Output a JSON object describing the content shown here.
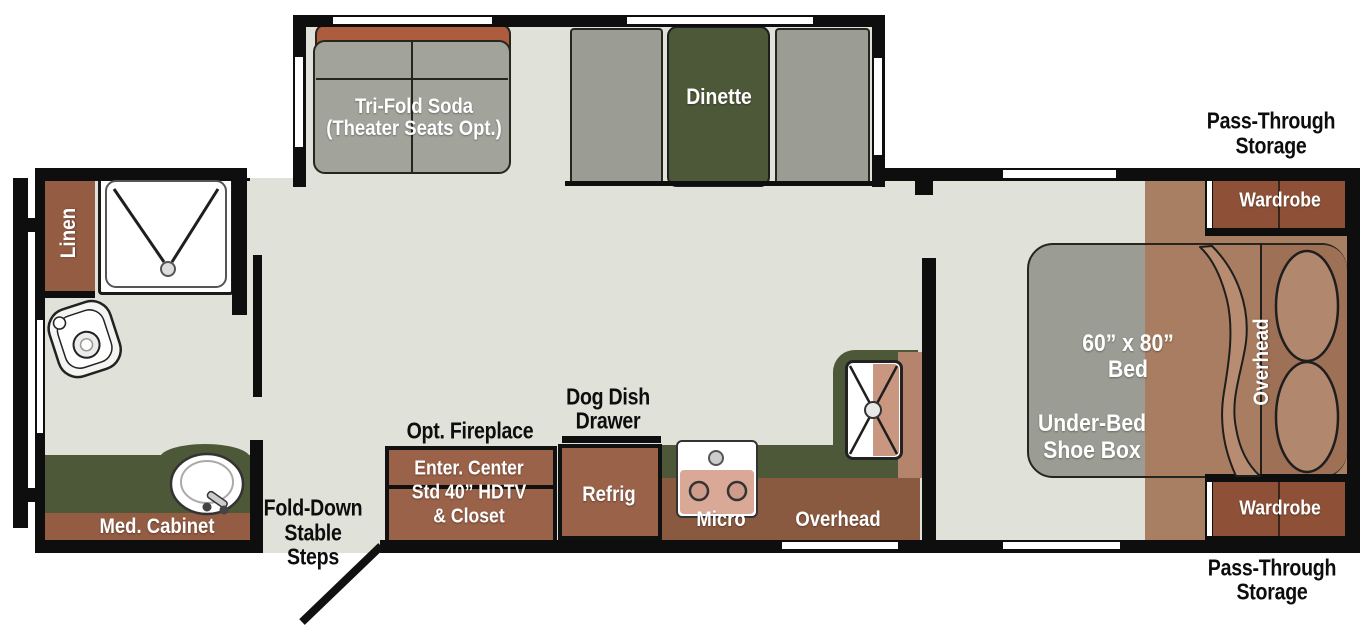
{
  "colors": {
    "floor": "#e0e1d8",
    "wall": "#0e0e0e",
    "cabinet_brown": "#9a6249",
    "dark_cabinet_brown": "#8e5138",
    "overhead_brown": "#8a5a40",
    "sofa_rust": "#ad5c3d",
    "cushion_gray": "#a2a49c",
    "counter_green": "#4c5837",
    "bedroom_floor": "#a97f63",
    "bed_gray": "#9b9d94",
    "bed_blanket": "#a87d61",
    "pillow": "#b1876d",
    "appliance_pink": "#d9a896"
  },
  "slideout": {
    "sofa_label_1": "Tri-Fold Soda",
    "sofa_label_2": "(Theater Seats Opt.)",
    "dinette_label": "Dinette"
  },
  "bathroom": {
    "linen": "Linen",
    "med_cabinet": "Med. Cabinet"
  },
  "entry": {
    "steps_1": "Fold-Down",
    "steps_2": "Stable",
    "steps_3": "Steps"
  },
  "kitchen": {
    "fireplace": "Opt. Fireplace",
    "enter_center_1": "Enter. Center",
    "enter_center_2": "Std 40” HDTV",
    "enter_center_3": "& Closet",
    "refrig": "Refrig",
    "dog_dish_1": "Dog Dish",
    "dog_dish_2": "Drawer",
    "micro": "Micro",
    "overhead": "Overhead"
  },
  "bedroom": {
    "bed_size_1": "60” x 80”",
    "bed_size_2": "Bed",
    "under_bed_1": "Under-Bed",
    "under_bed_2": "Shoe Box",
    "overhead": "Overhead",
    "wardrobe_top": "Wardrobe",
    "wardrobe_bottom": "Wardrobe",
    "pass_through_top_1": "Pass-Through",
    "pass_through_top_2": "Storage",
    "pass_through_bottom_1": "Pass-Through",
    "pass_through_bottom_2": "Storage"
  }
}
